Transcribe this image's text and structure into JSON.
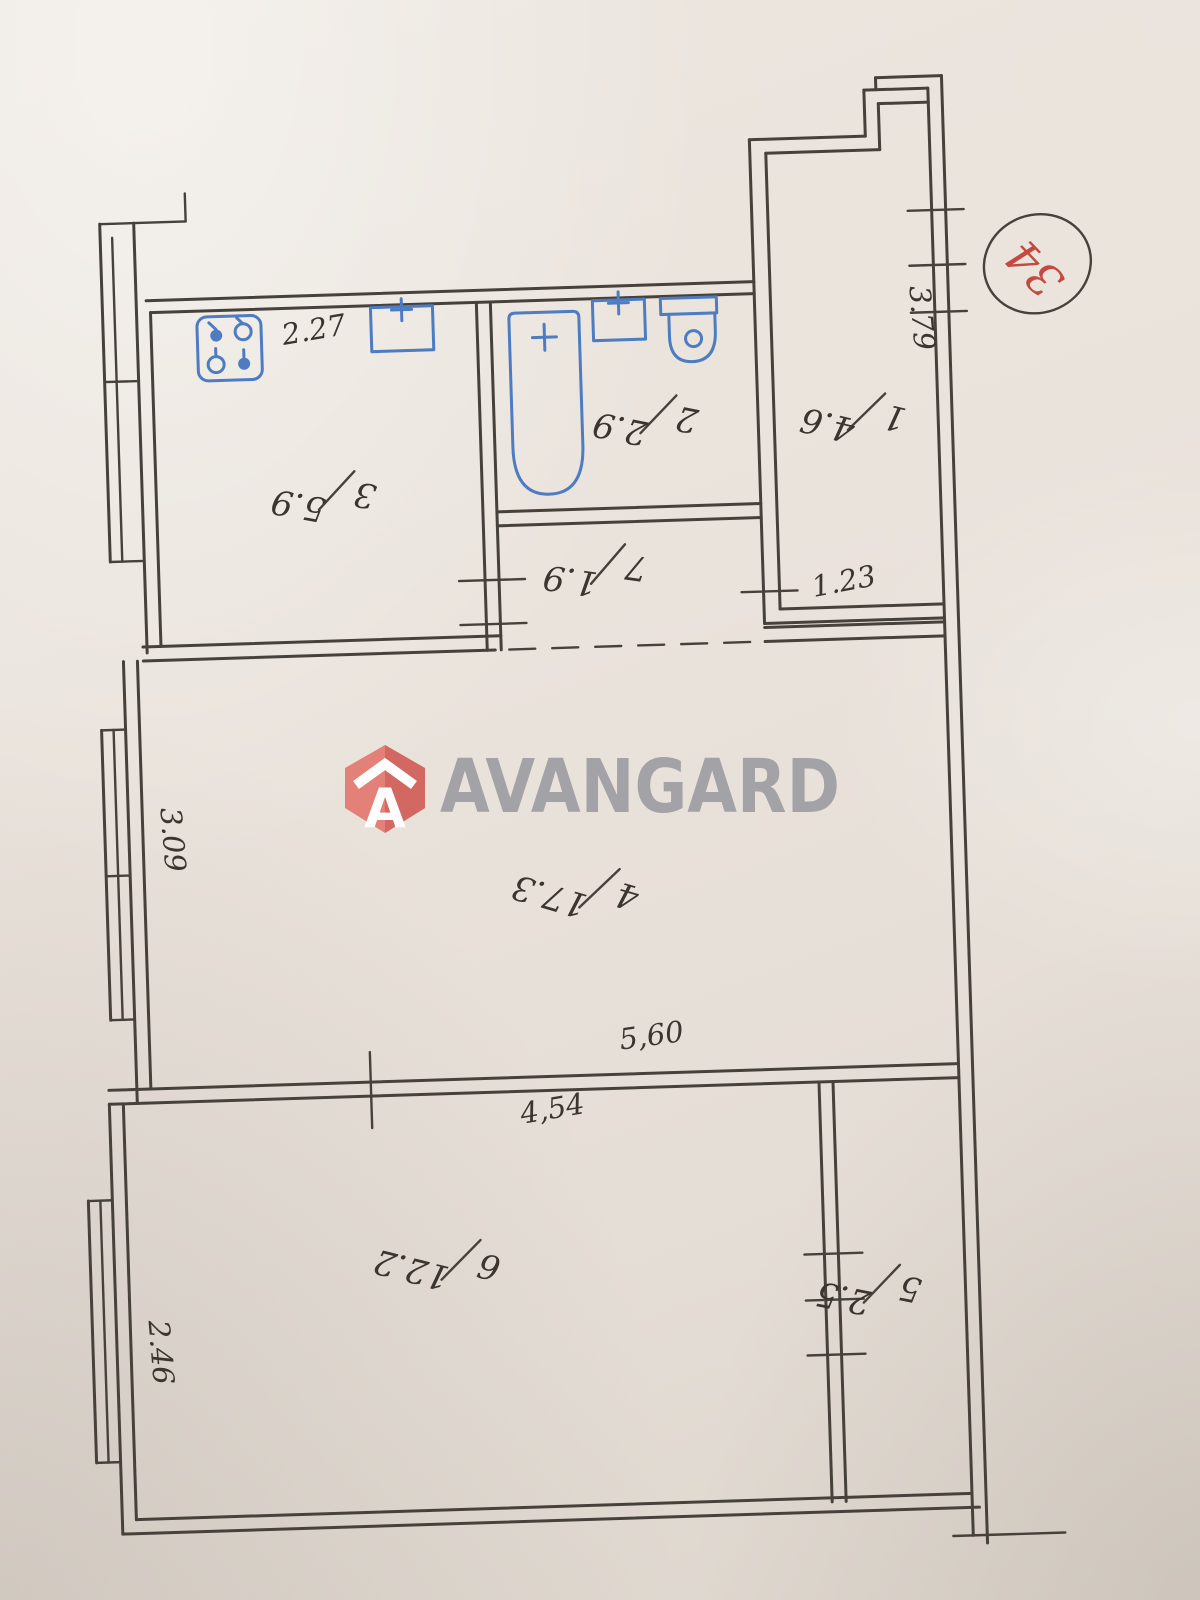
{
  "stamp": {
    "number": "34"
  },
  "watermark": {
    "brand": "AVANGARD",
    "logo_letter": "A"
  },
  "rooms": [
    {
      "number": "1",
      "area": "4.6"
    },
    {
      "number": "2",
      "area": "2.9"
    },
    {
      "number": "3",
      "area": "5.9"
    },
    {
      "number": "4",
      "area": "17.3"
    },
    {
      "number": "5",
      "area": "2.5"
    },
    {
      "number": "6",
      "area": "12.2"
    },
    {
      "number": "7",
      "area": "1.9"
    }
  ],
  "dimensions": {
    "kitchen_top": "2.27",
    "balcony_right": "3.79",
    "balcony_bottom": "1.23",
    "living_left": "3.09",
    "living_bottom": "5,60",
    "bedroom_top": "4,54",
    "bedroom_left": "2.46"
  },
  "colors": {
    "paper": "#e9e2da",
    "ink": "#46413b",
    "fixtures_blue": "#4d7cc2",
    "stamp_red": "#c44a41",
    "watermark_gray": "#9a99a0",
    "watermark_red": "#e37b72"
  }
}
